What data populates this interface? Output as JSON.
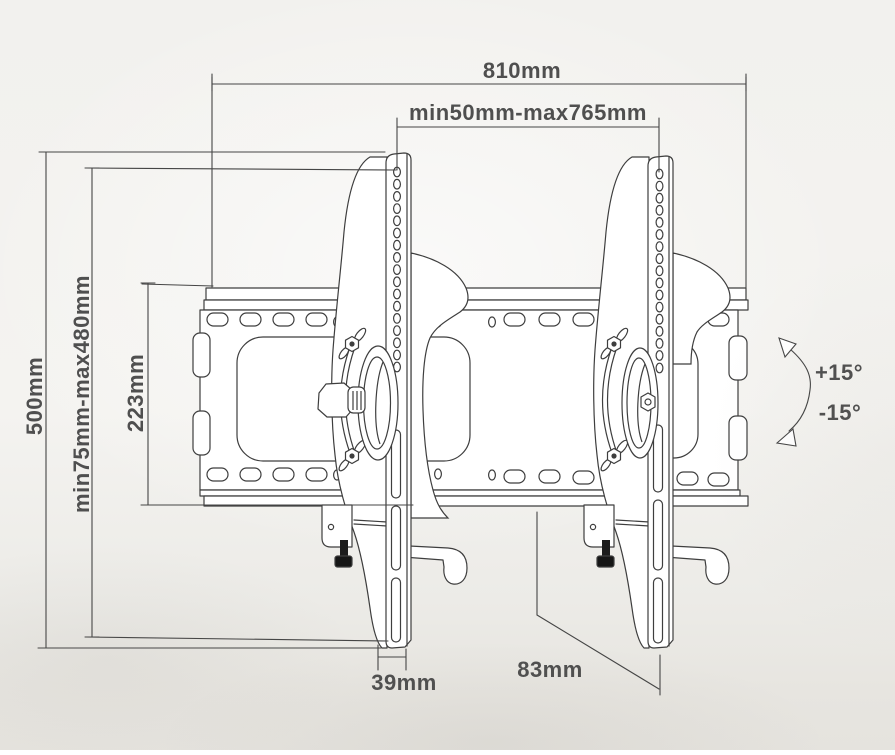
{
  "drawing": {
    "type": "technical dimension diagram",
    "subject": "tilting TV wall-mount bracket, side-front perspective line art",
    "colors": {
      "line": "#3e3e3e",
      "text": "#4f4f4f",
      "paper": "#f2f1ee",
      "hardware_dark": "#1c1c1c"
    },
    "dimensions": {
      "overall_width": "810mm",
      "rail_spacing_range": "min50mm-max765mm",
      "overall_height": "500mm",
      "vesa_vertical_range": "min75mm-max480mm",
      "plate_height": "223mm",
      "rail_width": "39mm",
      "mount_depth": "83mm",
      "tilt_up": "+15°",
      "tilt_down": "-15°"
    }
  }
}
